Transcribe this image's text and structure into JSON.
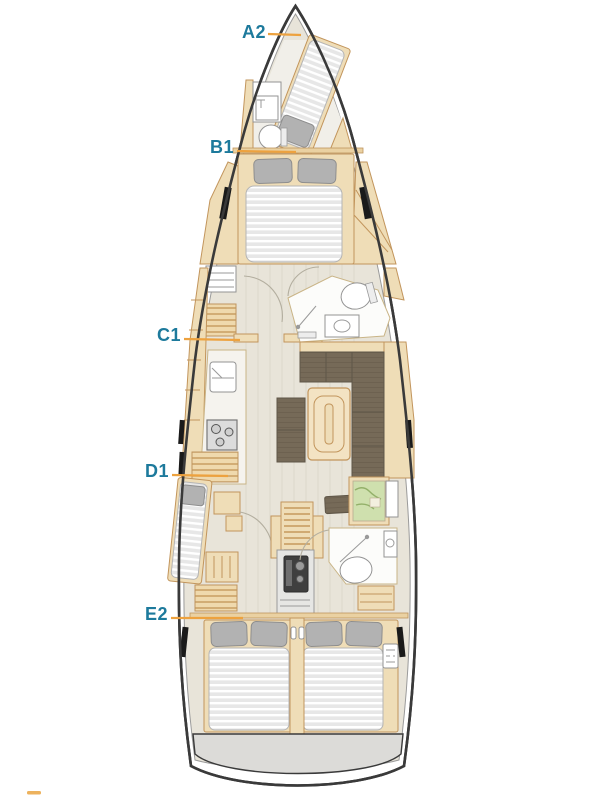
{
  "floorplan": {
    "type": "sailing-yacht-deck-plan",
    "cabin_labels": [
      {
        "id": "a2",
        "text": "A2"
      },
      {
        "id": "b1",
        "text": "B1"
      },
      {
        "id": "c1",
        "text": "C1"
      },
      {
        "id": "d1",
        "text": "D1"
      },
      {
        "id": "e2",
        "text": "E2"
      }
    ],
    "colors": {
      "label_text": "#1d7a9c",
      "leader_line": "#eda23f",
      "hull_outline": "#3a3a3a",
      "woodwork": "#efddb7",
      "wood_trim": "#c2955c",
      "floor": "#e8e4d9",
      "upholstery_dark": "#766a58",
      "mattress": "#e7e7e7",
      "pillow": "#b2b2b2",
      "chart_map": "#cfe0ae",
      "swim_platform": "#dcdbd8"
    },
    "features": [
      "forepeak-berth",
      "bow-wc",
      "forward-double-bed",
      "midship-head",
      "galley",
      "salon-sofa",
      "salon-table",
      "nav-station",
      "port-single-berth",
      "companionway-stairs",
      "engine",
      "aft-head",
      "aft-port-double-bed",
      "aft-starboard-double-bed",
      "swim-platform"
    ]
  }
}
